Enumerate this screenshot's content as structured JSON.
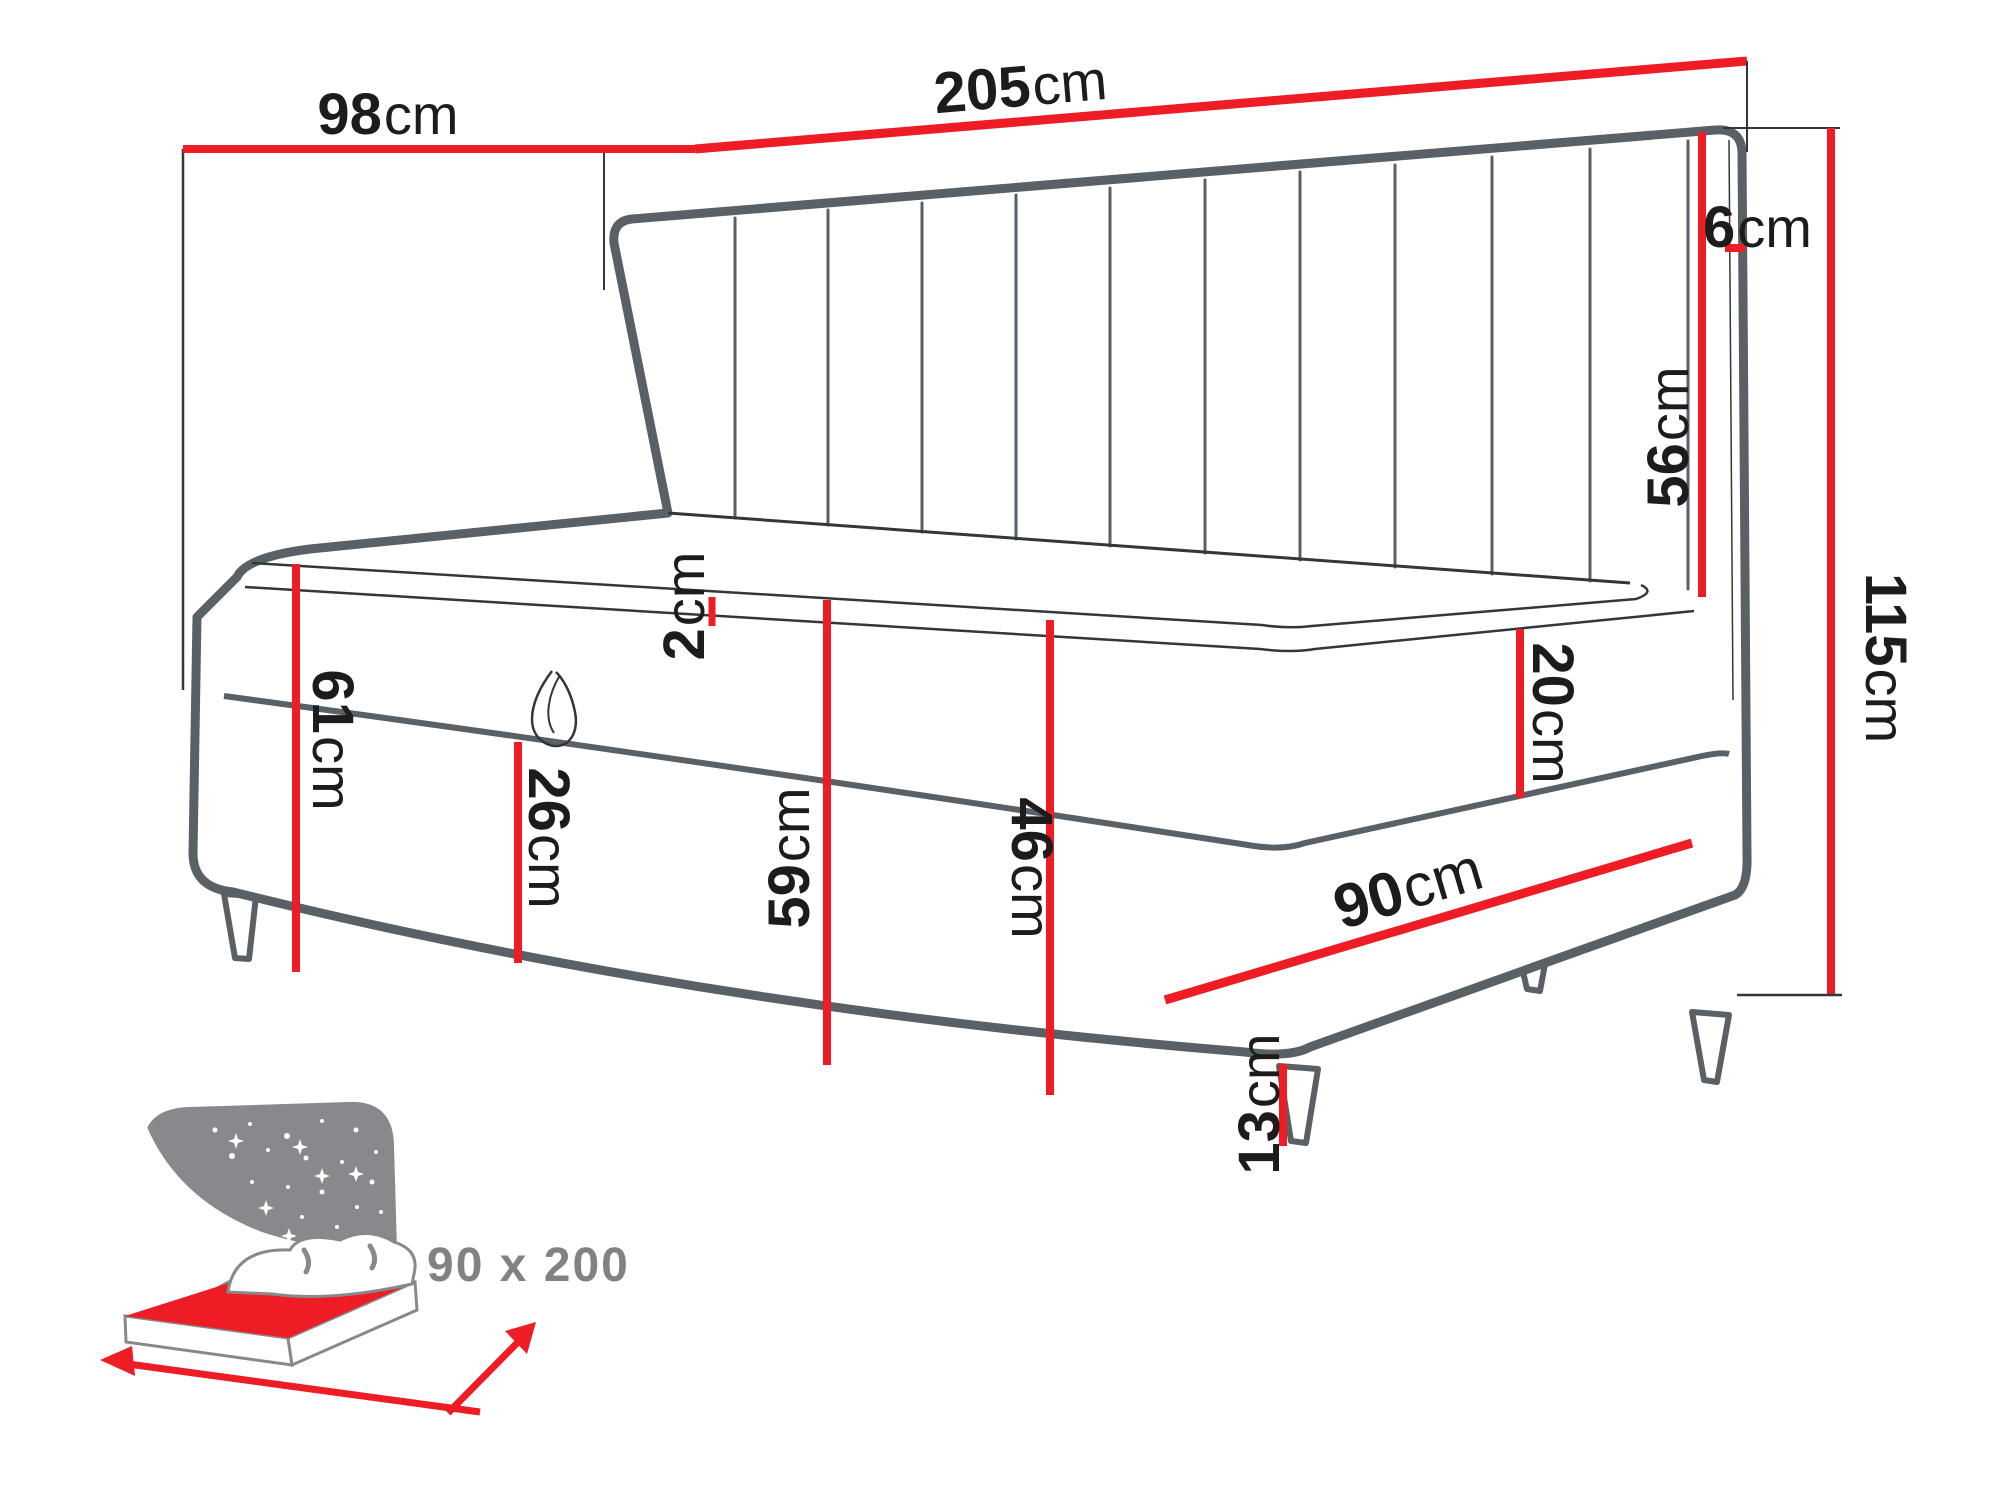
{
  "diagram": {
    "title": "bed-dimension-diagram",
    "accent_color": "#ee1c24",
    "outline_color": "#596066",
    "text_color": "#1d1b1b",
    "icon_gray": "#87898c",
    "badge_gray": "#808285"
  },
  "dimensions": {
    "side_panel_width": {
      "value": "98",
      "unit": "cm"
    },
    "total_length": {
      "value": "205",
      "unit": "cm"
    },
    "headboard_thickness": {
      "value": "6",
      "unit": "cm"
    },
    "headboard_height": {
      "value": "56",
      "unit": "cm"
    },
    "total_height": {
      "value": "115",
      "unit": "cm"
    },
    "topper_height": {
      "value": "2",
      "unit": "cm"
    },
    "seat_height": {
      "value": "61",
      "unit": "cm"
    },
    "storage_front_height": {
      "value": "26",
      "unit": "cm"
    },
    "base_height": {
      "value": "59",
      "unit": "cm"
    },
    "frame_height": {
      "value": "46",
      "unit": "cm"
    },
    "mattress_height": {
      "value": "20",
      "unit": "cm"
    },
    "bed_width": {
      "value": "90",
      "unit": "cm"
    },
    "leg_height": {
      "value": "13",
      "unit": "cm"
    }
  },
  "badge": {
    "size_label": "90 x 200"
  }
}
